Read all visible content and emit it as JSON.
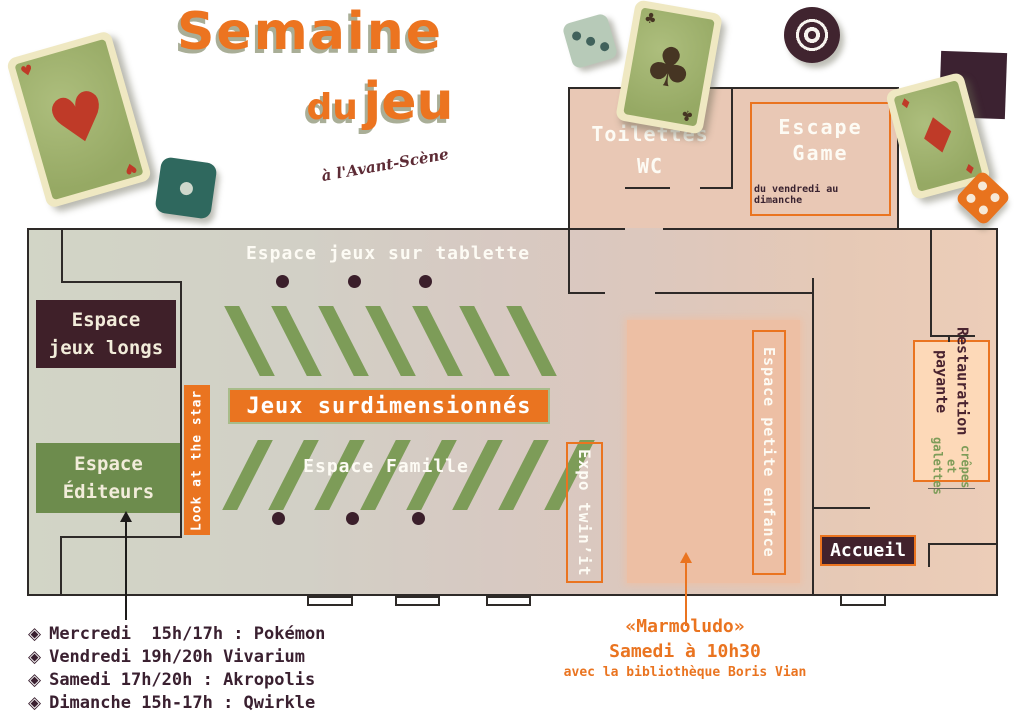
{
  "title": {
    "word1": "Semaine",
    "word2": "du",
    "word3": "jeu",
    "subtitle": "à l'Avant-Scène"
  },
  "plan": {
    "upper_room": {
      "toilettes_line1": "Toilettes",
      "toilettes_line2": "WC",
      "escape_line1": "Escape",
      "escape_line2": "Game",
      "escape_note": "du vendredi au dimanche"
    },
    "hall": {
      "tablette_label": "Espace jeux sur tablette",
      "jeux_longs_line1": "Espace",
      "jeux_longs_line2": "jeux longs",
      "editeurs_line1": "Espace",
      "editeurs_line2": "Éditeurs",
      "look_star_label": "Look at the star",
      "surdim_label": "Jeux surdimensionnés",
      "famille_label": "Espace Famille",
      "expo_label": "Expo twin’it",
      "petite_enfance_label": "Espace petite enfance",
      "restauration_line1": "Restauration",
      "restauration_line2": "payante",
      "restauration_note": "crêpes et galettes",
      "accueil_label": "Accueil"
    }
  },
  "schedule": {
    "bullet": "◈",
    "items": [
      {
        "text": "Mercredi  15h/17h : Pokémon"
      },
      {
        "text": "Vendredi 19h/20h Vivarium"
      },
      {
        "text": "Samedi 17h/20h : Akropolis"
      },
      {
        "text": "Dimanche 15h-17h : Qwirkle"
      }
    ]
  },
  "marmoludo": {
    "line1": "«Marmoludo»",
    "line2": "Samedi à 10h30",
    "line3": "avec la bibliothèque Boris Vian"
  },
  "decorations": {
    "heart_glyph": "♥",
    "club_glyph": "♣",
    "diamond_glyph": "♦",
    "names": [
      "ace-of-hearts-card",
      "teal-die",
      "three-dot-die",
      "ace-of-clubs-card",
      "bullseye-target",
      "dark-square-tile",
      "ace-of-diamonds-card",
      "orange-die"
    ]
  },
  "colors": {
    "orange": "#ea7420",
    "maroon": "#3f2130",
    "green": "#7d9c58",
    "salmon_room": "#e9c8b5",
    "pink_zone": "#edbfa4",
    "peach_box": "#fdd9b8"
  }
}
